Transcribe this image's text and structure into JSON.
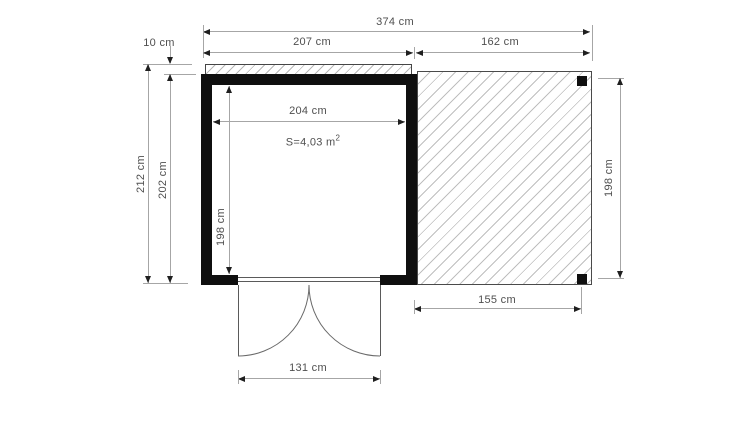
{
  "drawing": {
    "kind": "garden-shed floor plan with side pergola",
    "unit": "cm",
    "area_label": "S=4,03 m",
    "area_sup": "2"
  },
  "labels": {
    "total_width": "374 cm",
    "roof_offset": "10 cm",
    "building_width": "207 cm",
    "pergola_width": "162 cm",
    "total_depth": "212 cm",
    "building_depth": "202 cm",
    "interior_width": "204 cm",
    "interior_depth": "198 cm",
    "pergola_depth": "198 cm",
    "pergola_floor_width": "155 cm",
    "door_width": "131 cm"
  },
  "colors": {
    "wall": "#0f0f0f",
    "dim_line": "#a6a6a6",
    "arrow": "#1f1f1f",
    "text": "#4f4f4f",
    "hatch": "#b8b8b8",
    "background": "#ffffff"
  }
}
